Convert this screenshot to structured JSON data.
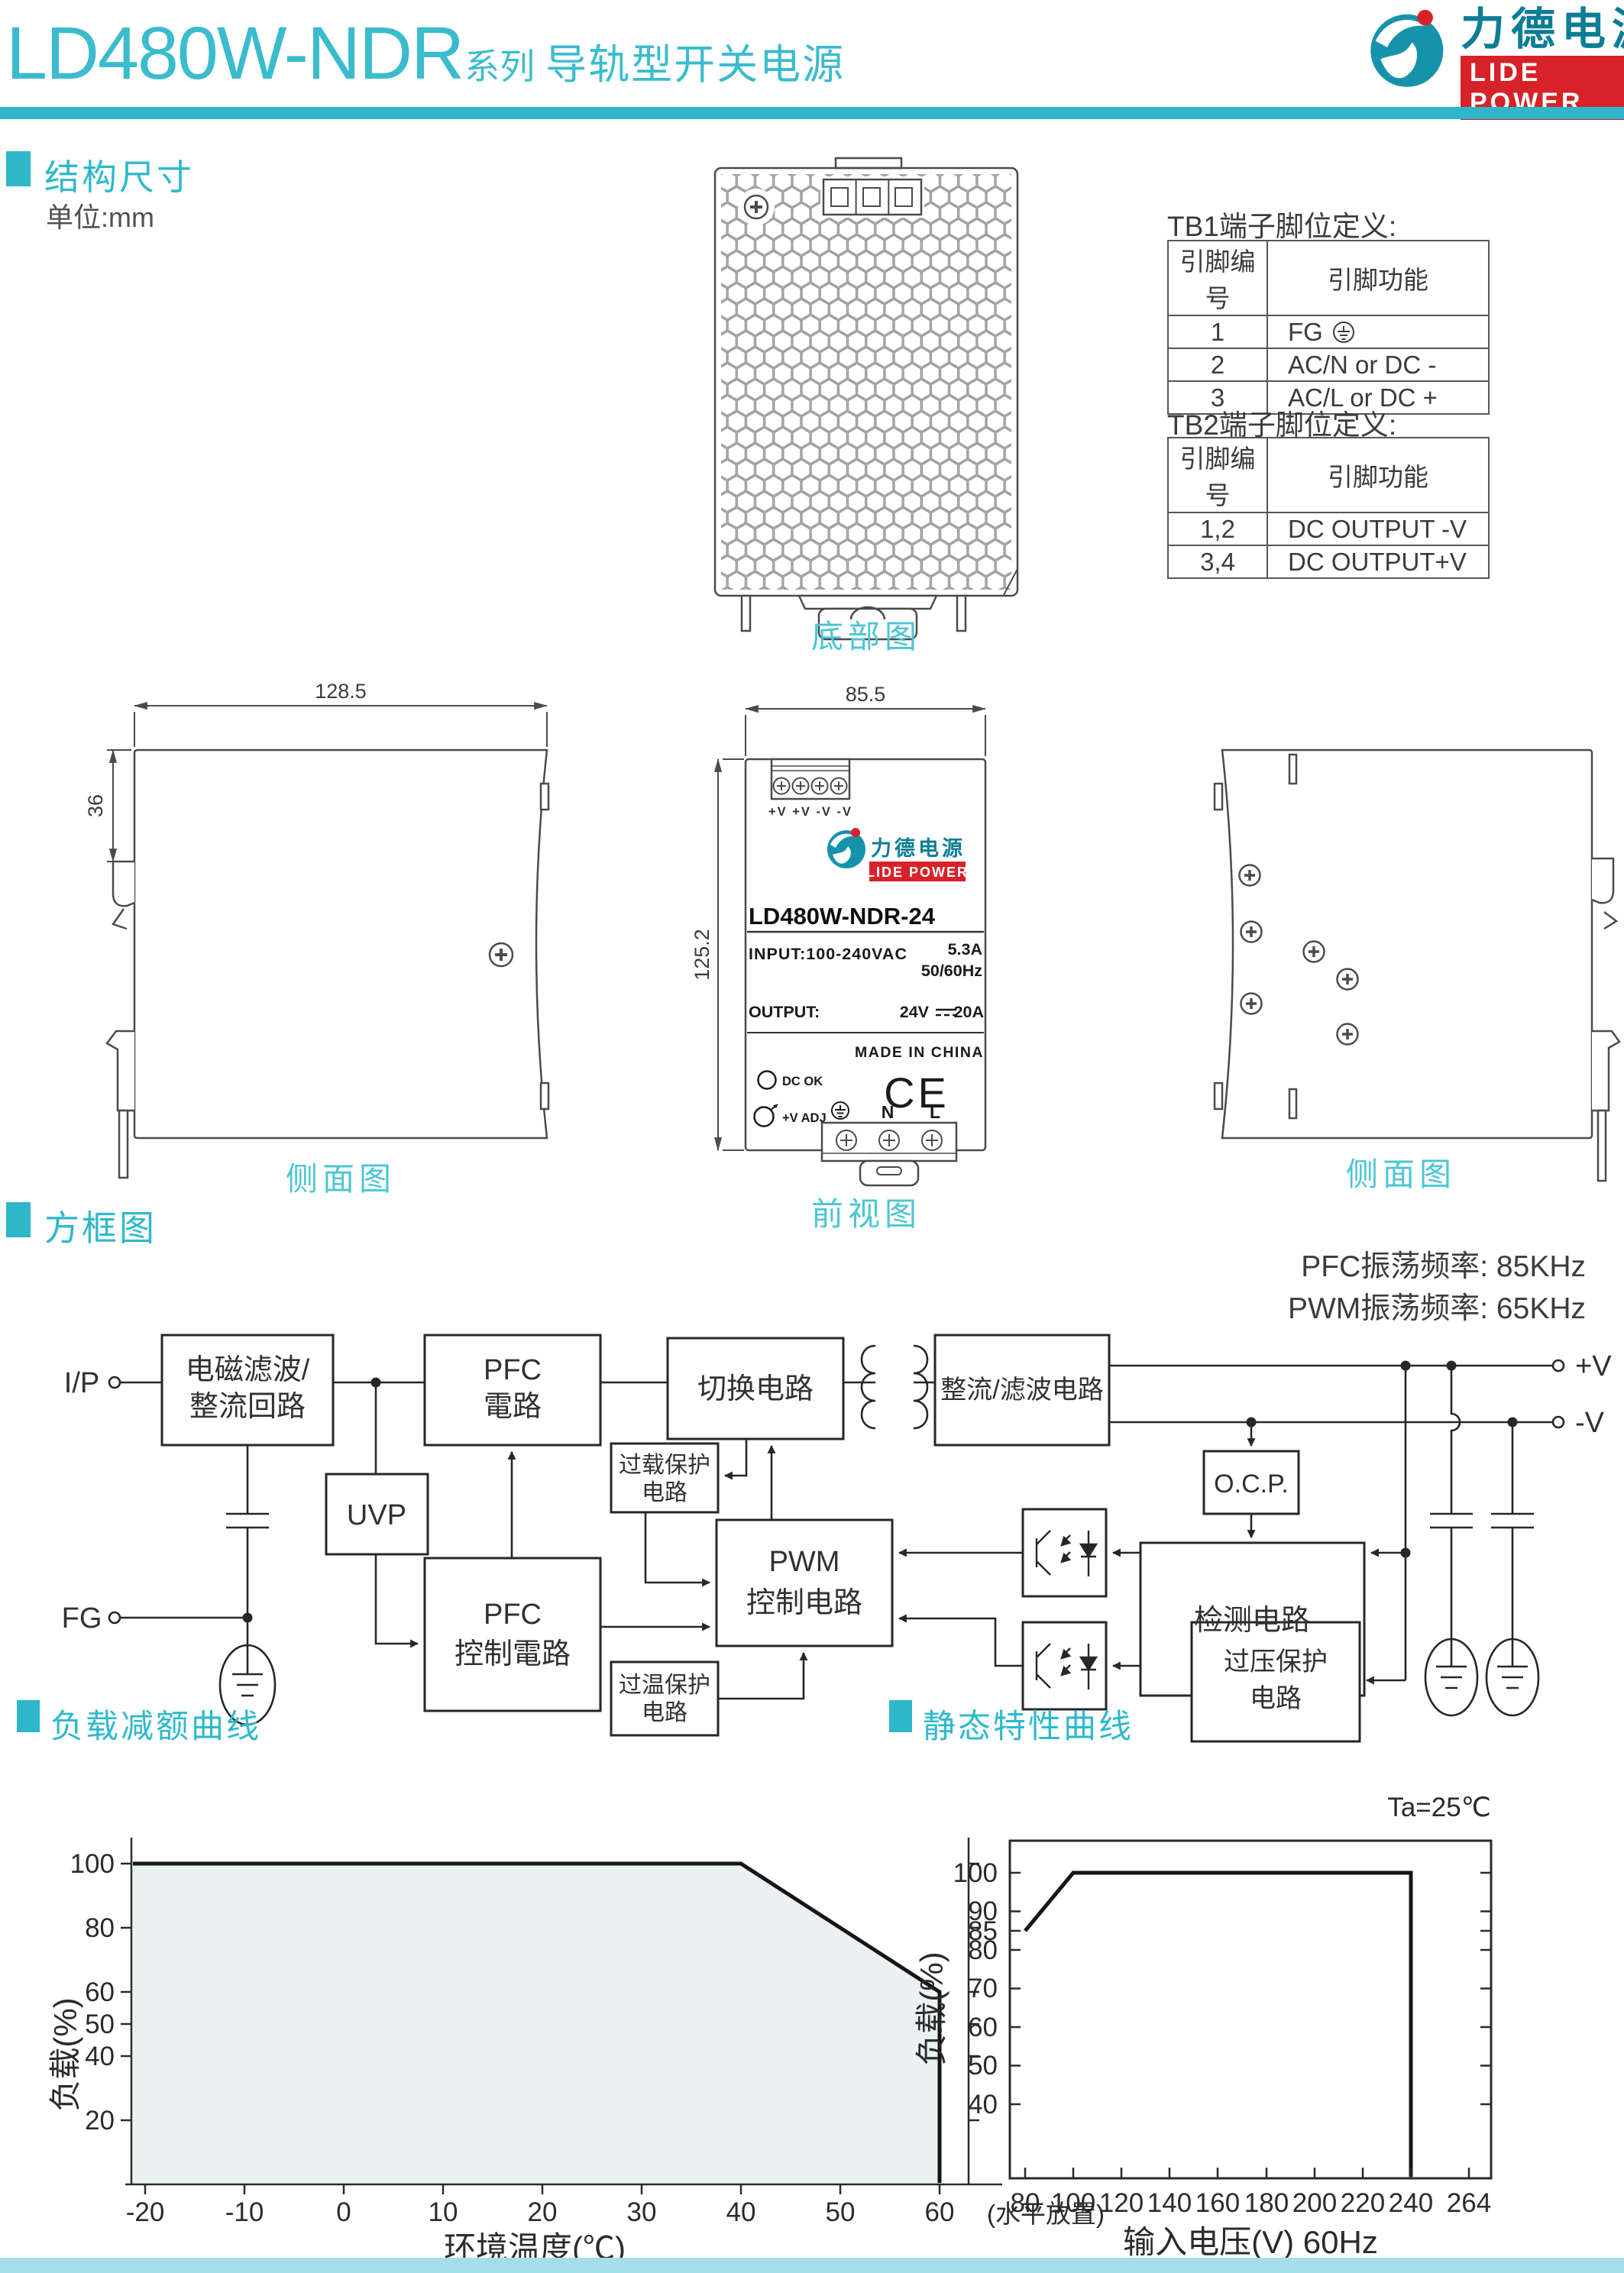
{
  "page": {
    "accent": "#2db7c9",
    "label_color": "#4cc5d6",
    "bottom_bar": "#a5dde9"
  },
  "header": {
    "model": "LD480W-NDR",
    "series": "系列",
    "subtitle": "导轨型开关电源"
  },
  "logo": {
    "cn": "力德电源",
    "en": "LIDE POWER"
  },
  "section1": {
    "title": "结构尺寸",
    "unit": "单位:mm"
  },
  "views": {
    "bottom": "底部图",
    "side_left": "侧面图",
    "front": "前视图",
    "side_right": "侧面图"
  },
  "dims": {
    "w": "128.5",
    "h36": "36",
    "fw": "85.5",
    "fh": "125.2"
  },
  "tb1": {
    "title": "TB1端子脚位定义:",
    "h1": "引脚编号",
    "h2": "引脚功能",
    "rows": [
      {
        "pin": "1",
        "fn": "FG"
      },
      {
        "pin": "2",
        "fn": "AC/N or DC -"
      },
      {
        "pin": "3",
        "fn": "AC/L  or DC +"
      }
    ]
  },
  "tb2": {
    "title": "TB2端子脚位定义:",
    "h1": "引脚编号",
    "h2": "引脚功能",
    "rows": [
      {
        "pin": "1,2",
        "fn": "DC OUTPUT -V"
      },
      {
        "pin": "3,4",
        "fn": "DC OUTPUT+V"
      }
    ]
  },
  "front_panel": {
    "terminals_top": "+V  +V  -V  -V",
    "model": "LD480W-NDR-24",
    "input": "INPUT:100-240VAC",
    "current": "5.3A",
    "freq": "50/60Hz",
    "output": "OUTPUT:",
    "outv": "24V",
    "outa": "20A",
    "made": "MADE IN CHINA",
    "dcok": "DC OK",
    "vadj": "+V ADJ",
    "ce": "CE",
    "n": "N",
    "l": "L"
  },
  "section2": {
    "title": "方框图",
    "pfc_freq": "PFC振荡频率: 85KHz",
    "pwm_freq": "PWM振荡频率: 65KHz"
  },
  "block": {
    "ip": "I/P",
    "fg": "FG",
    "pv": "+V",
    "nv": "-V",
    "emi1": "电磁滤波/",
    "emi2": "整流回路",
    "pfc1": "PFC",
    "pfc2": "電路",
    "sw": "切换电路",
    "rect": "整流/滤波电路",
    "uvp": "UVP",
    "pfcc1": "PFC",
    "pfcc2": "控制電路",
    "olp1": "过载保护",
    "olp2": "电路",
    "pwm1": "PWM",
    "pwm2": "控制电路",
    "otp1": "过温保护",
    "otp2": "电路",
    "ocp": "O.C.P.",
    "det": "检测电路",
    "ovp1": "过压保护",
    "ovp2": "电路"
  },
  "section3": {
    "title": "负载减额曲线"
  },
  "section4": {
    "title": "静态特性曲线",
    "ta": "Ta=25℃"
  },
  "chart_data": [
    {
      "type": "area",
      "title": "负载减额曲线",
      "xlabel": "环境温度(℃)",
      "ylabel": "负载(%)",
      "annotation": "(水平放置)",
      "x": [
        -20,
        40,
        60,
        60
      ],
      "y": [
        100,
        100,
        60,
        0
      ],
      "xticks": [
        "-20",
        "-10",
        "0",
        "10",
        "20",
        "30",
        "40",
        "50",
        "60"
      ],
      "yticks": [
        "20",
        "40",
        "50",
        "60",
        "80",
        "100"
      ],
      "xlim": [
        -20,
        65
      ],
      "ylim": [
        0,
        110
      ],
      "fill": "#e9f1f2",
      "grid": false,
      "legend": "none"
    },
    {
      "type": "line",
      "title": "静态特性曲线",
      "xlabel": "输入电压(V) 60Hz",
      "ylabel": "负载(%)",
      "annotation": "Ta=25℃",
      "x": [
        80,
        100,
        240,
        240
      ],
      "y": [
        85,
        100,
        100,
        0
      ],
      "xticks": [
        "80",
        "100",
        "120",
        "140",
        "160",
        "180",
        "200",
        "220",
        "240",
        "264"
      ],
      "yticks": [
        "40",
        "50",
        "60",
        "70",
        "80",
        "85",
        "90",
        "100"
      ],
      "xlim": [
        75,
        272
      ],
      "ylim": [
        28,
        107
      ],
      "grid": false,
      "legend": "none"
    }
  ]
}
